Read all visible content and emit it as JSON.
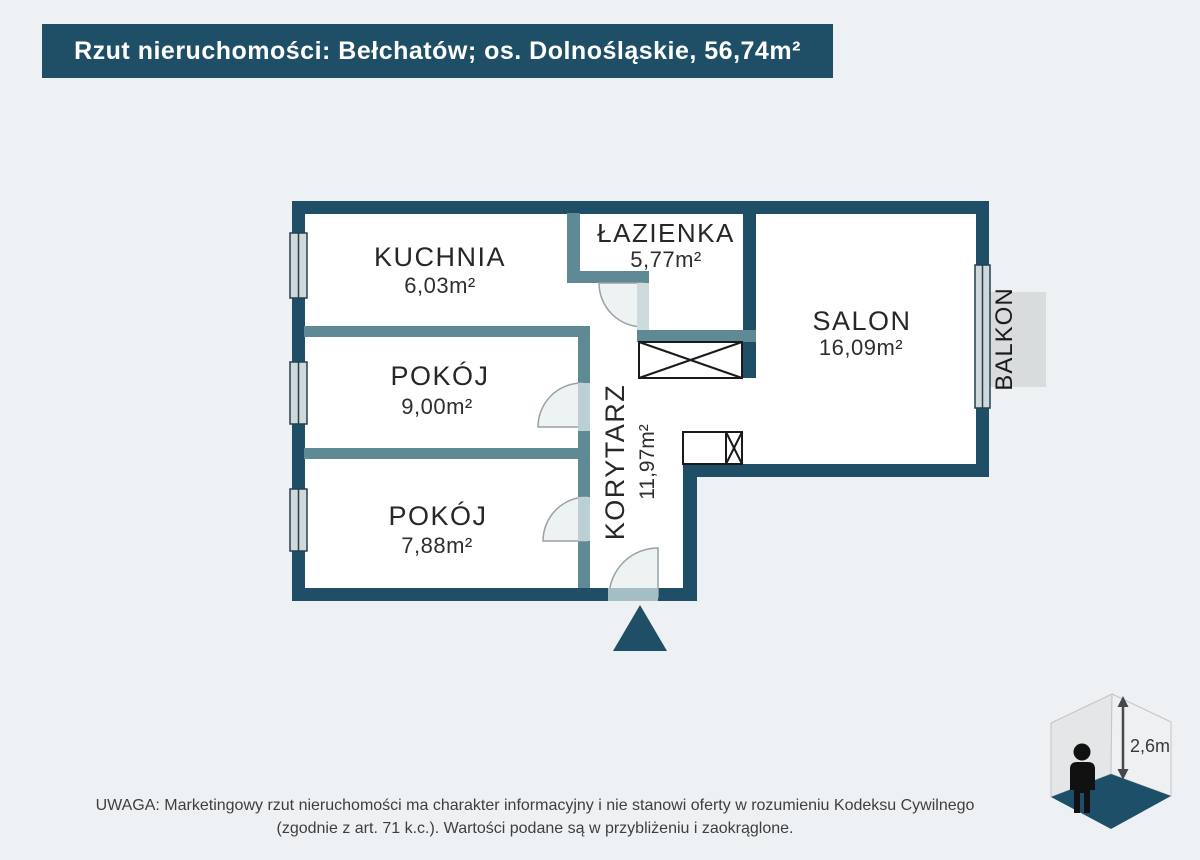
{
  "header": {
    "title": "Rzut nieruchomości: Bełchatów; os. Dolnośląskie, 56,74m²"
  },
  "plan": {
    "rooms": [
      {
        "name": "KUCHNIA",
        "area": "6,03m²"
      },
      {
        "name": "ŁAZIENKA",
        "area": "5,77m²"
      },
      {
        "name": "SALON",
        "area": "16,09m²"
      },
      {
        "name": "POKÓJ",
        "area": "9,00m²"
      },
      {
        "name": "POKÓJ",
        "area": "7,88m²"
      },
      {
        "name": "KORYTARZ",
        "area": "11,97m²"
      }
    ],
    "balcony_label": "BALKON"
  },
  "ceiling": {
    "height_label": "2,6m"
  },
  "footer": {
    "line1": "UWAGA: Marketingowy rzut nieruchomości ma charakter informacyjny i nie stanowi oferty w rozumieniu Kodeksu Cywilnego",
    "line2": "(zgodnie z art. 71 k.c.). Wartości podane są w przybliżeniu i zaokrąglone."
  },
  "colors": {
    "wall_dark": "#1e4f66",
    "wall_light": "#5e8995",
    "floor_accent": "#1d5068",
    "background": "#eef1f3"
  }
}
